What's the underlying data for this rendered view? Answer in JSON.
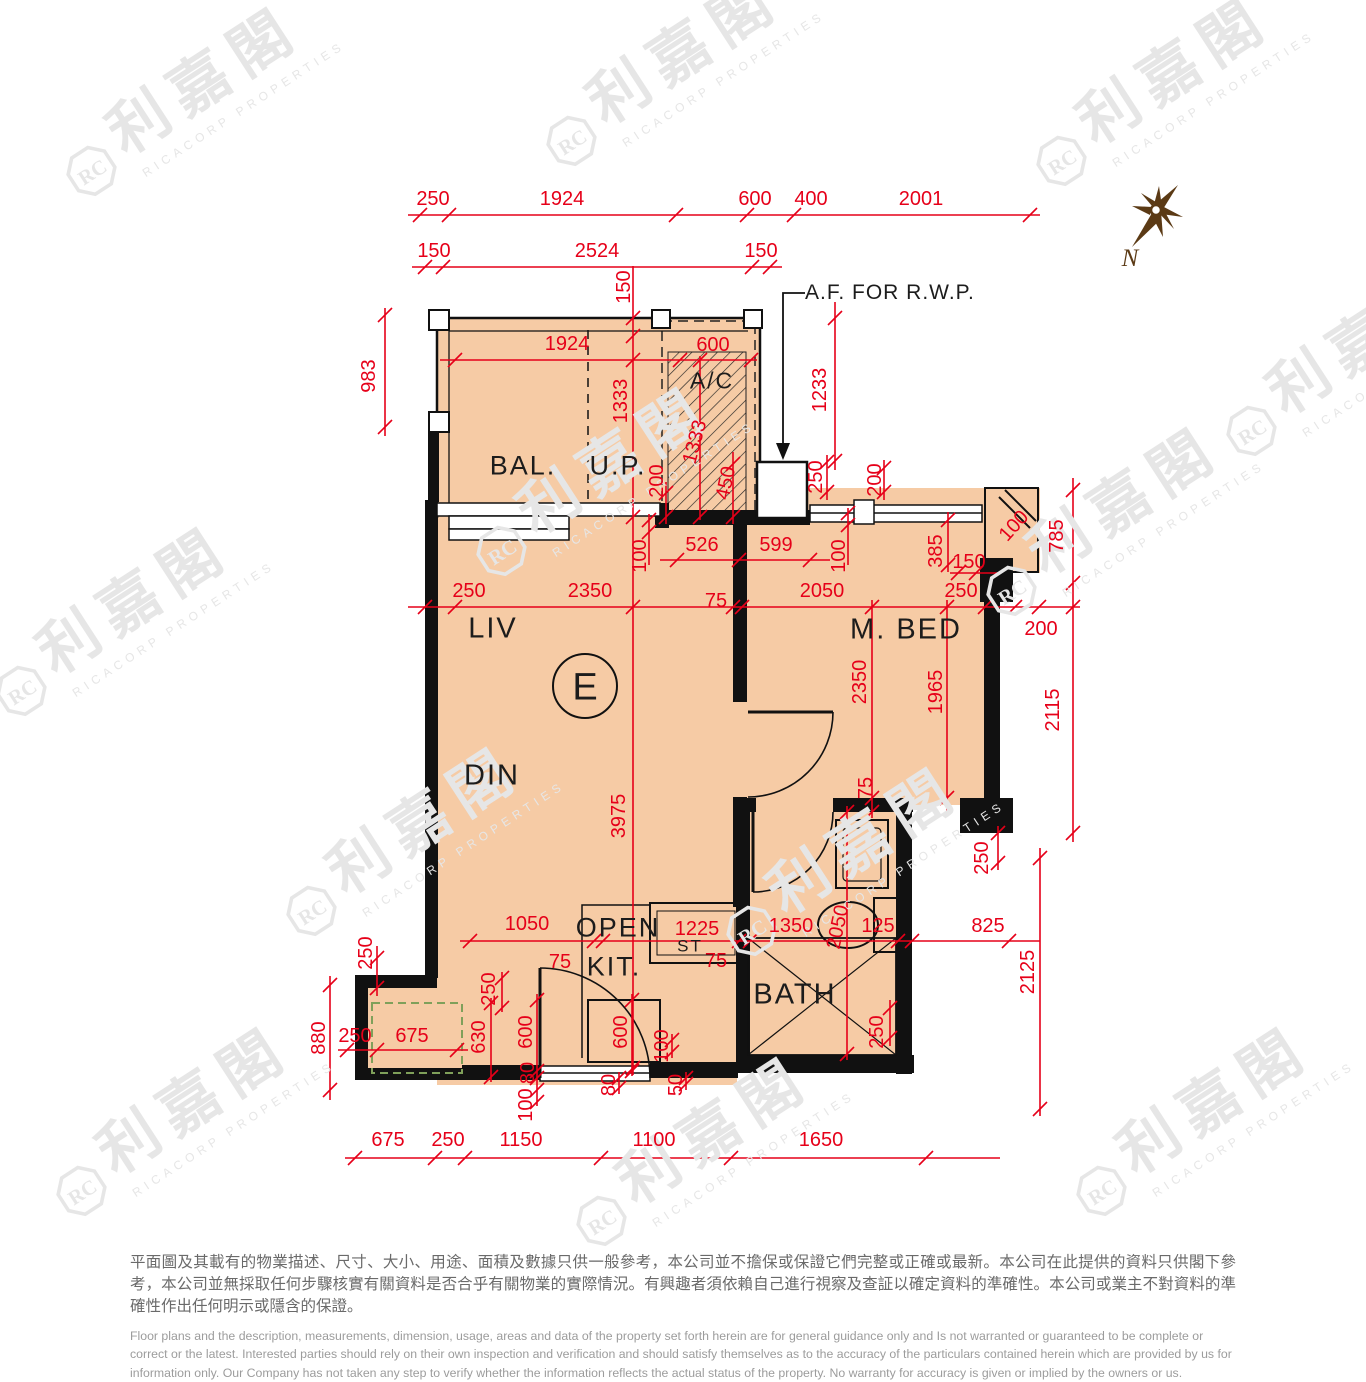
{
  "watermark": {
    "cjk": "利嘉閣",
    "en": "RICACORP PROPERTIES"
  },
  "compass": {
    "label": "N"
  },
  "plan": {
    "unit": "E",
    "annotation_af": "A.F. FOR R.W.P.",
    "rooms": [
      {
        "id": "bal",
        "label": "BAL."
      },
      {
        "id": "up",
        "label": "U.P."
      },
      {
        "id": "ac",
        "label": "A/C"
      },
      {
        "id": "liv",
        "label": "LIV"
      },
      {
        "id": "din",
        "label": "DIN"
      },
      {
        "id": "mbed",
        "label": "M. BED"
      },
      {
        "id": "open",
        "label": "OPEN"
      },
      {
        "id": "kit",
        "label": "KIT."
      },
      {
        "id": "st",
        "label": "ST"
      },
      {
        "id": "bath",
        "label": "BATH"
      }
    ],
    "dims": [
      {
        "id": "top_250",
        "t": "250"
      },
      {
        "id": "top_1924",
        "t": "1924"
      },
      {
        "id": "top_600",
        "t": "600"
      },
      {
        "id": "top_400",
        "t": "400"
      },
      {
        "id": "top_2001",
        "t": "2001"
      },
      {
        "id": "top2_150L",
        "t": "150"
      },
      {
        "id": "top2_2524",
        "t": "2524"
      },
      {
        "id": "top2_150R",
        "t": "150"
      },
      {
        "id": "bal_150v",
        "t": "150"
      },
      {
        "id": "bal_1924",
        "t": "1924"
      },
      {
        "id": "ac_600",
        "t": "600"
      },
      {
        "id": "up_1333",
        "t": "1333"
      },
      {
        "id": "ac_1333",
        "t": "1333"
      },
      {
        "id": "up_200",
        "t": "200"
      },
      {
        "id": "ac_450",
        "t": "450"
      },
      {
        "id": "rwp_1233",
        "t": "1233"
      },
      {
        "id": "rwp_250",
        "t": "250"
      },
      {
        "id": "rwp_200",
        "t": "200"
      },
      {
        "id": "liv_100",
        "t": "100"
      },
      {
        "id": "liv_526",
        "t": "526"
      },
      {
        "id": "liv_599",
        "t": "599"
      },
      {
        "id": "mbed_100a",
        "t": "100"
      },
      {
        "id": "mbed_385",
        "t": "385"
      },
      {
        "id": "mbed_150",
        "t": "150"
      },
      {
        "id": "bay_100",
        "t": "100"
      },
      {
        "id": "bay_785",
        "t": "785"
      },
      {
        "id": "row_250L",
        "t": "250"
      },
      {
        "id": "row_2350",
        "t": "2350"
      },
      {
        "id": "row_75",
        "t": "75"
      },
      {
        "id": "row_2050",
        "t": "2050"
      },
      {
        "id": "row_250R",
        "t": "250"
      },
      {
        "id": "row_200",
        "t": "200"
      },
      {
        "id": "mbed_2350v",
        "t": "2350"
      },
      {
        "id": "mbed_1965v",
        "t": "1965"
      },
      {
        "id": "right_2115",
        "t": "2115"
      },
      {
        "id": "liv_3975",
        "t": "3975"
      },
      {
        "id": "mbed_75v",
        "t": "75"
      },
      {
        "id": "notch_250",
        "t": "250"
      },
      {
        "id": "bath_2050v",
        "t": "2050"
      },
      {
        "id": "right_2125",
        "t": "2125"
      },
      {
        "id": "bath_250v",
        "t": "250"
      },
      {
        "id": "kit_1050",
        "t": "1050"
      },
      {
        "id": "kit_75a",
        "t": "75"
      },
      {
        "id": "st_1225",
        "t": "1225"
      },
      {
        "id": "st_75",
        "t": "75"
      },
      {
        "id": "bath_1350",
        "t": "1350"
      },
      {
        "id": "bath_125",
        "t": "125"
      },
      {
        "id": "right_825",
        "t": "825"
      },
      {
        "id": "ent_250",
        "t": "250"
      },
      {
        "id": "ent_630",
        "t": "630"
      },
      {
        "id": "ent_600",
        "t": "600"
      },
      {
        "id": "ent_80",
        "t": "80"
      },
      {
        "id": "ent_100",
        "t": "100"
      },
      {
        "id": "kit_600v",
        "t": "600"
      },
      {
        "id": "kit_100v",
        "t": "100"
      },
      {
        "id": "kit_80",
        "t": "80"
      },
      {
        "id": "kit_50",
        "t": "50"
      },
      {
        "id": "left_983",
        "t": "983"
      },
      {
        "id": "left_250v",
        "t": "250"
      },
      {
        "id": "left_880",
        "t": "880"
      },
      {
        "id": "util_250",
        "t": "250"
      },
      {
        "id": "util_675",
        "t": "675"
      },
      {
        "id": "bot_675",
        "t": "675"
      },
      {
        "id": "bot_250",
        "t": "250"
      },
      {
        "id": "bot_1150",
        "t": "1150"
      },
      {
        "id": "bot_1100",
        "t": "1100"
      },
      {
        "id": "bot_1650",
        "t": "1650"
      }
    ]
  },
  "footer": {
    "zh": "平面圖及其載有的物業描述、尺寸、大小、用途、面積及數據只供一般參考，本公司並不擔保或保證它們完整或正確或最新。本公司在此提供的資料只供閣下參考，本公司並無採取任何步驟核實有關資料是否合乎有關物業的實際情況。有興趣者須依賴自己進行視察及查証以確定資料的準確性。本公司或業主不對資料的準確性作出任何明示或隱含的保證。",
    "en": "Floor plans and the description, measurements, dimension, usage, areas and data of the property set forth herein are for general guidance only and Is not warranted or guaranteed to be complete or correct or the latest.  Interested parties should rely on their own inspection and verification and should satisfy themselves as to the accuracy of the particulars contained herein which are provided by us for information only.  Our Company has not taken any step to verify whether the information reflects the actual status of the property.  No warranty for accuracy is given or implied by the owners or us."
  },
  "colors": {
    "dimension_red": "#E60019",
    "wall_black": "#111111",
    "floor_peach": "#F6CBA5",
    "watermark_gray": "#E6E6E6",
    "compass_brown": "#5B3A15",
    "utility_green": "#7FA05A"
  }
}
